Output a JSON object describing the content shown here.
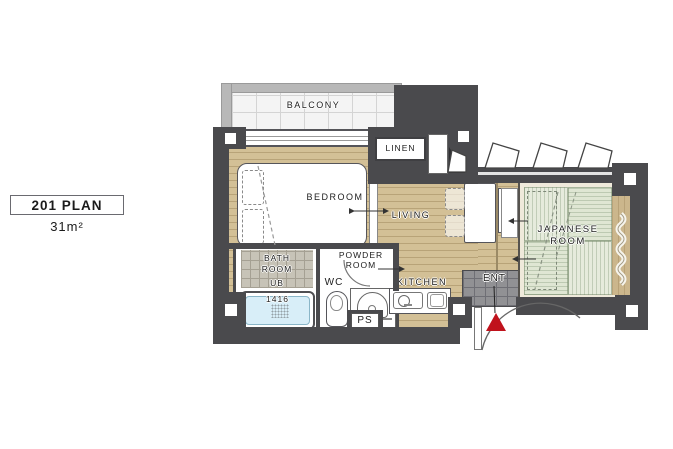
{
  "plan": {
    "title": "201 PLAN",
    "area": "31m²"
  },
  "rooms": {
    "balcony": "BALCONY",
    "bedroom": "BEDROOM",
    "linen": "LINEN",
    "living": "LIVING",
    "japanese_line1": "JAPANESE",
    "japanese_line2": "ROOM",
    "bath_line1": "BATH",
    "bath_line2": "ROOM",
    "bath_unit": "UB",
    "bath_size": "1416",
    "wc": "WC",
    "powder_line1": "POWDER",
    "powder_line2": "ROOM",
    "kitchen": "KITCHEN",
    "pipe_space": "PS",
    "entrance": "ENT"
  },
  "colors": {
    "wall": "#4a4a4d",
    "wood": "#d3c096",
    "tatami": "#e6ebdc",
    "entrance_tile": "#919194",
    "bathtub": "#d8eef8",
    "entrance_marker": "#c0121c",
    "balcony_rail": "#b8b8b8"
  }
}
